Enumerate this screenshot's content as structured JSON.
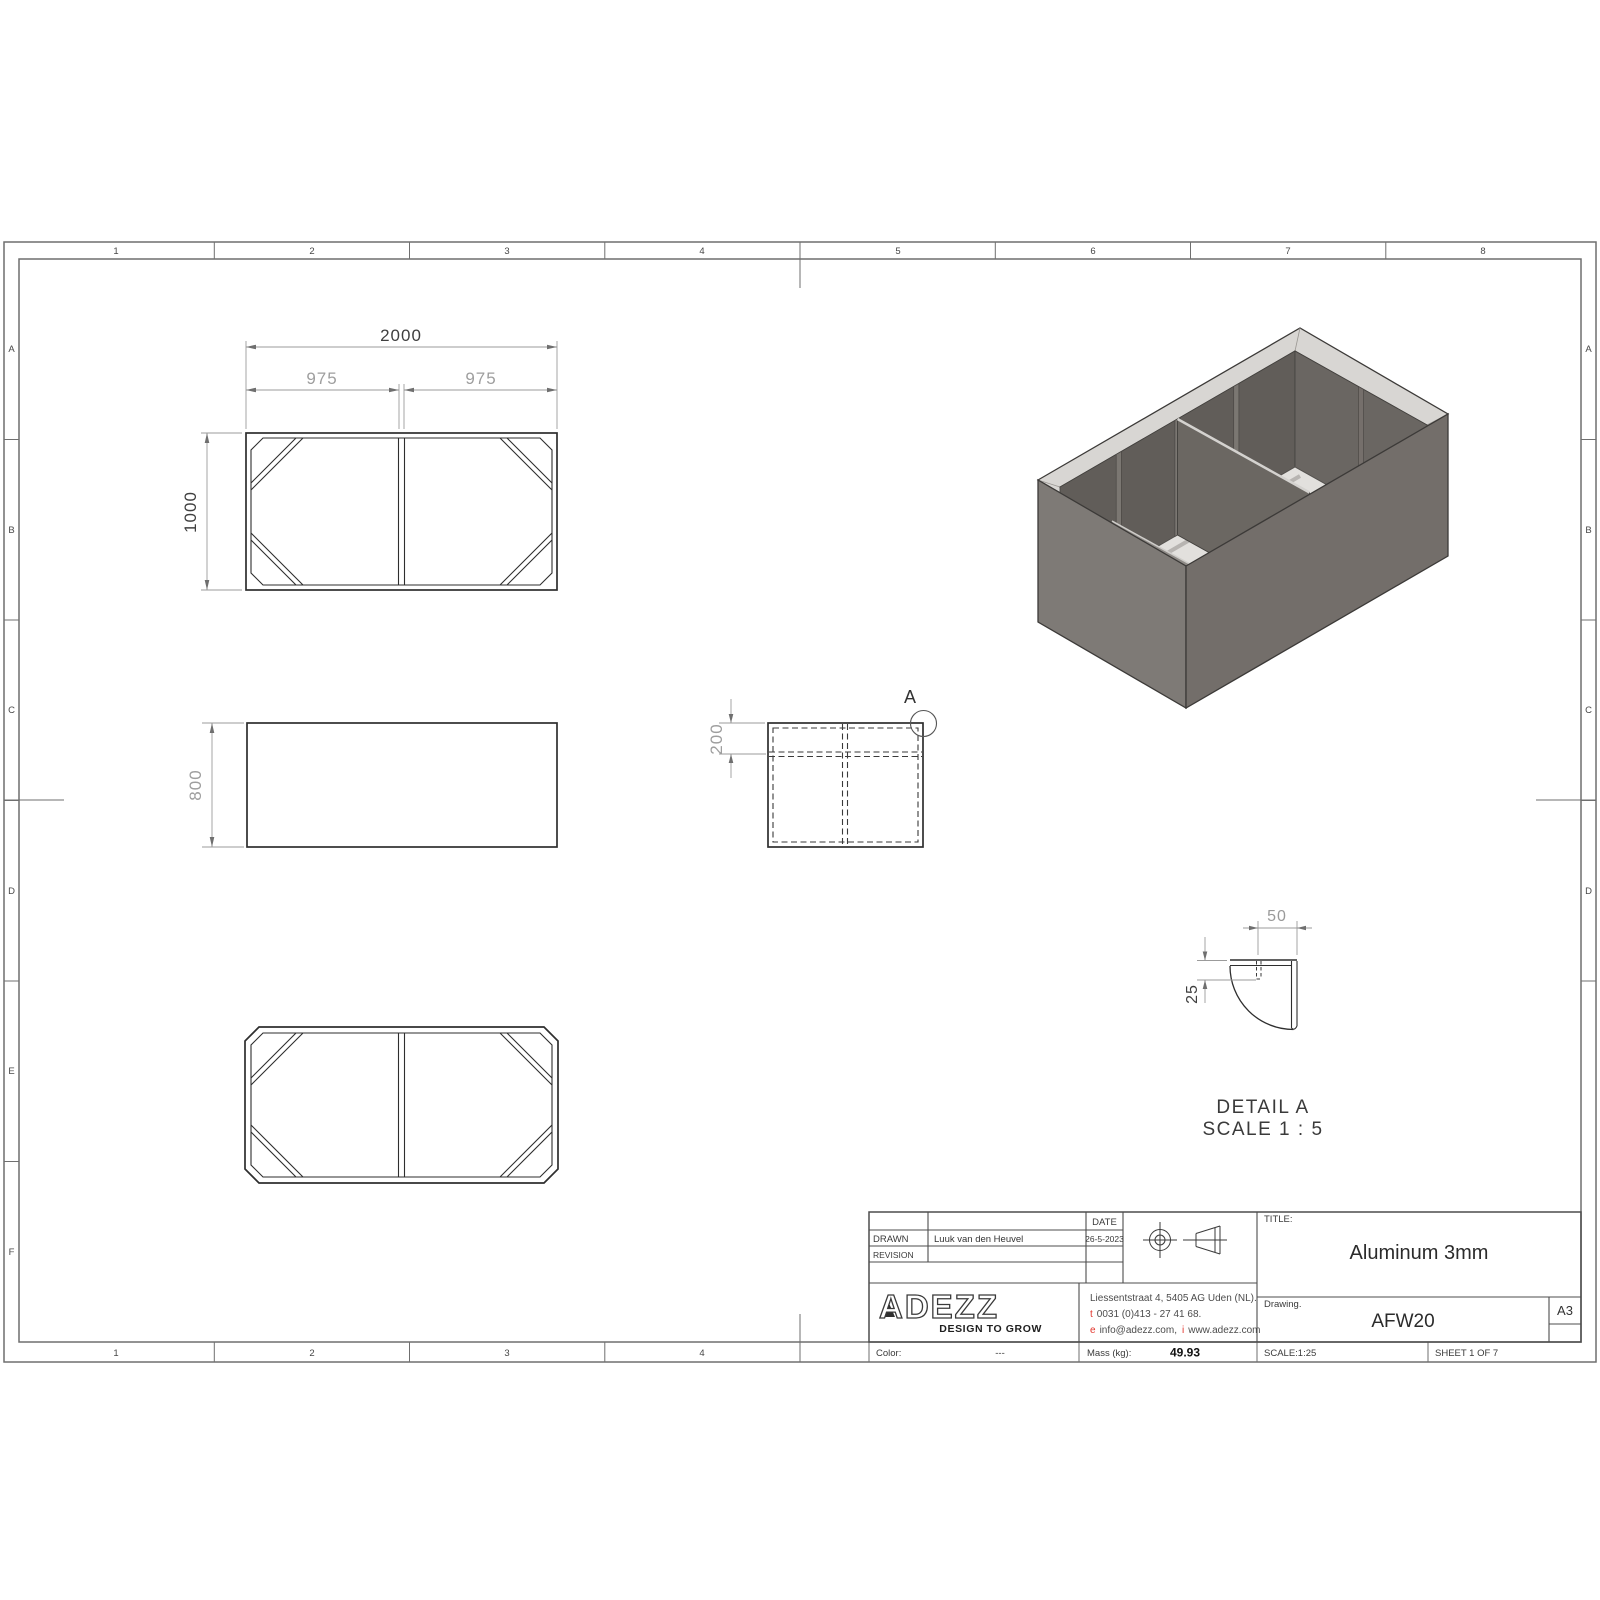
{
  "sheet": {
    "cols": [
      "1",
      "2",
      "3",
      "4",
      "5",
      "6",
      "7",
      "8"
    ],
    "rows": [
      "A",
      "B",
      "C",
      "D",
      "E",
      "F"
    ],
    "rows_right": [
      "A",
      "B",
      "C",
      "D"
    ]
  },
  "views": {
    "top": {
      "w": "2000",
      "w_left": "975",
      "w_right": "975",
      "h": "1000"
    },
    "front": {
      "h": "800"
    },
    "side": {
      "soil_depth": "200",
      "detail_mark": "A"
    },
    "detail": {
      "w": "50",
      "h": "25",
      "name": "DETAIL A",
      "scale": "SCALE 1 : 5"
    }
  },
  "titleblock": {
    "drawn_label": "DRAWN",
    "drawn_by": "Luuk van den Heuvel",
    "revision_label": "REVISION",
    "date_label": "DATE",
    "date": "26-5-2023",
    "title_label": "TITLE:",
    "title": "Aluminum 3mm",
    "drawing_label": "Drawing.",
    "drawing_no": "AFW20",
    "paper_size": "A3",
    "color_label": "Color:",
    "color": "---",
    "mass_label": "Mass (kg):",
    "mass": "49.93",
    "scale": "SCALE:1:25",
    "sheet": "SHEET 1 OF 7"
  },
  "company": {
    "name": "ADEZZ",
    "tagline": "DESIGN TO GROW",
    "address": "Liessentstraat 4, 5405 AG Uden (NL).",
    "phone_prefix": "t",
    "phone": "0031 (0)413 - 27 41 68.",
    "email_prefix": "e",
    "email": "info@adezz.com,",
    "web_prefix": "i",
    "web": "www.adezz.com"
  },
  "colors": {
    "line": "#2e2e2e",
    "dim_gray": "#9e9e9e",
    "frame_gray": "#6f6f6f",
    "accent_red": "#e2342b",
    "iso_rim": "#d8d6d3",
    "iso_left_face": "#7e7a76",
    "iso_right_face": "#736e6a",
    "iso_cavity": "#615d59"
  }
}
